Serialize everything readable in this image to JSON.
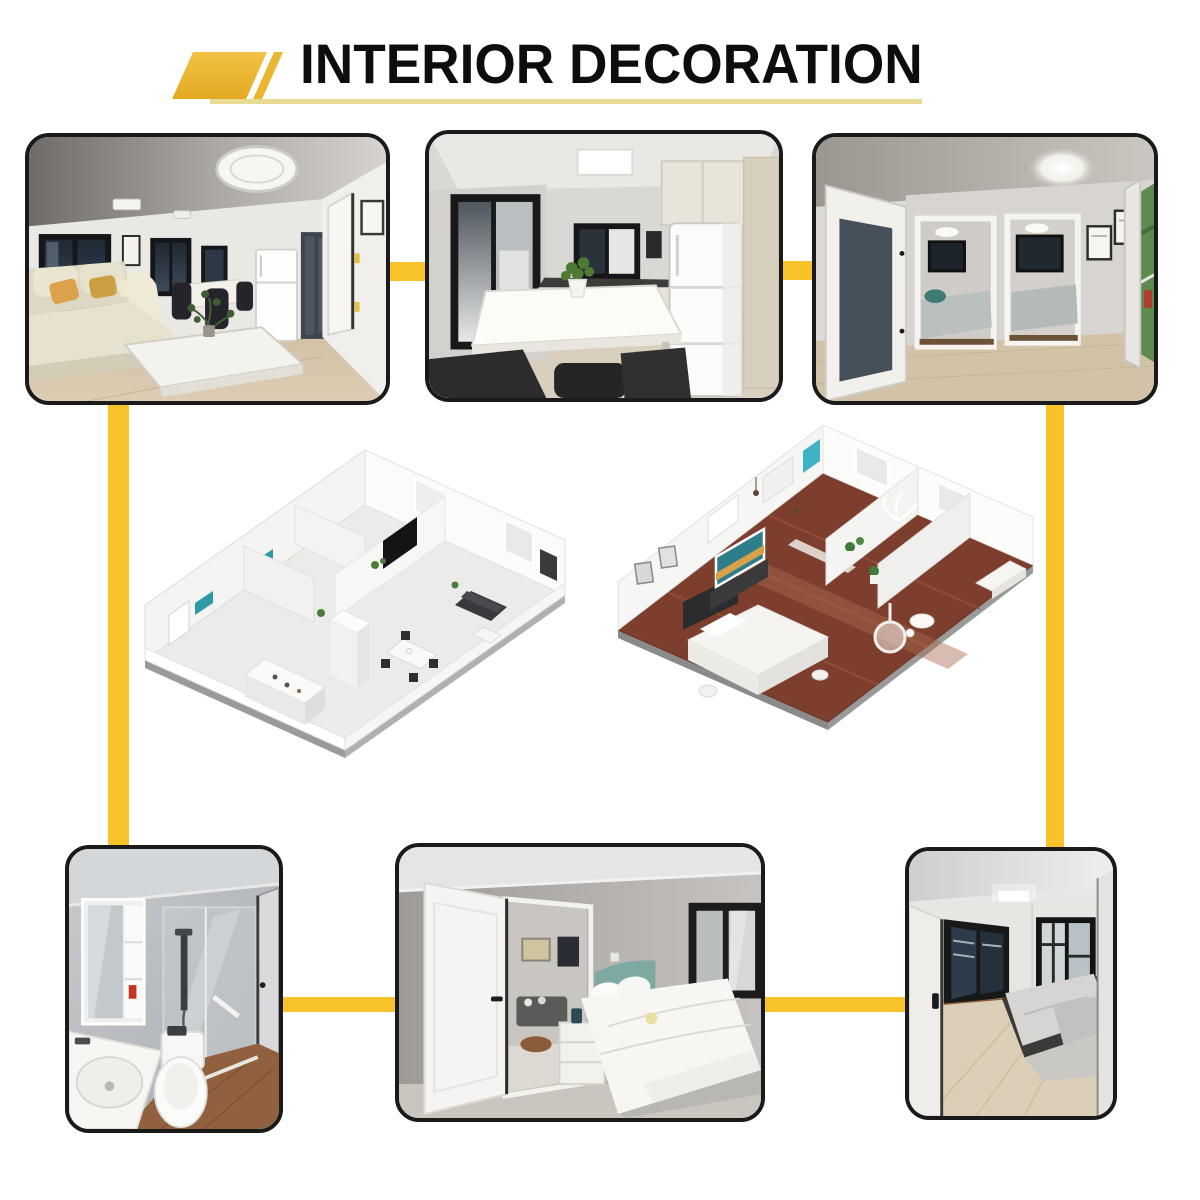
{
  "page": {
    "background_color": "#ffffff"
  },
  "header": {
    "title": "INTERIOR DECORATION",
    "title_color": "#0d0d0d",
    "logo_color": "#EAB531",
    "underline_color": "#E8DC94"
  },
  "connectors": {
    "color": "#F8C329"
  },
  "gallery": {
    "frame_color": "#1a1a1a",
    "photos": [
      {
        "id": "living-room",
        "position": "top-left"
      },
      {
        "id": "kitchen-dining",
        "position": "top-center"
      },
      {
        "id": "bedroom-hallway",
        "position": "top-right"
      },
      {
        "id": "isometric-floorplan-white",
        "position": "middle-left"
      },
      {
        "id": "isometric-floorplan-wood-floor",
        "position": "middle-right"
      },
      {
        "id": "bathroom",
        "position": "bottom-left"
      },
      {
        "id": "bedroom",
        "position": "bottom-center"
      },
      {
        "id": "small-bedroom",
        "position": "bottom-right"
      }
    ]
  }
}
